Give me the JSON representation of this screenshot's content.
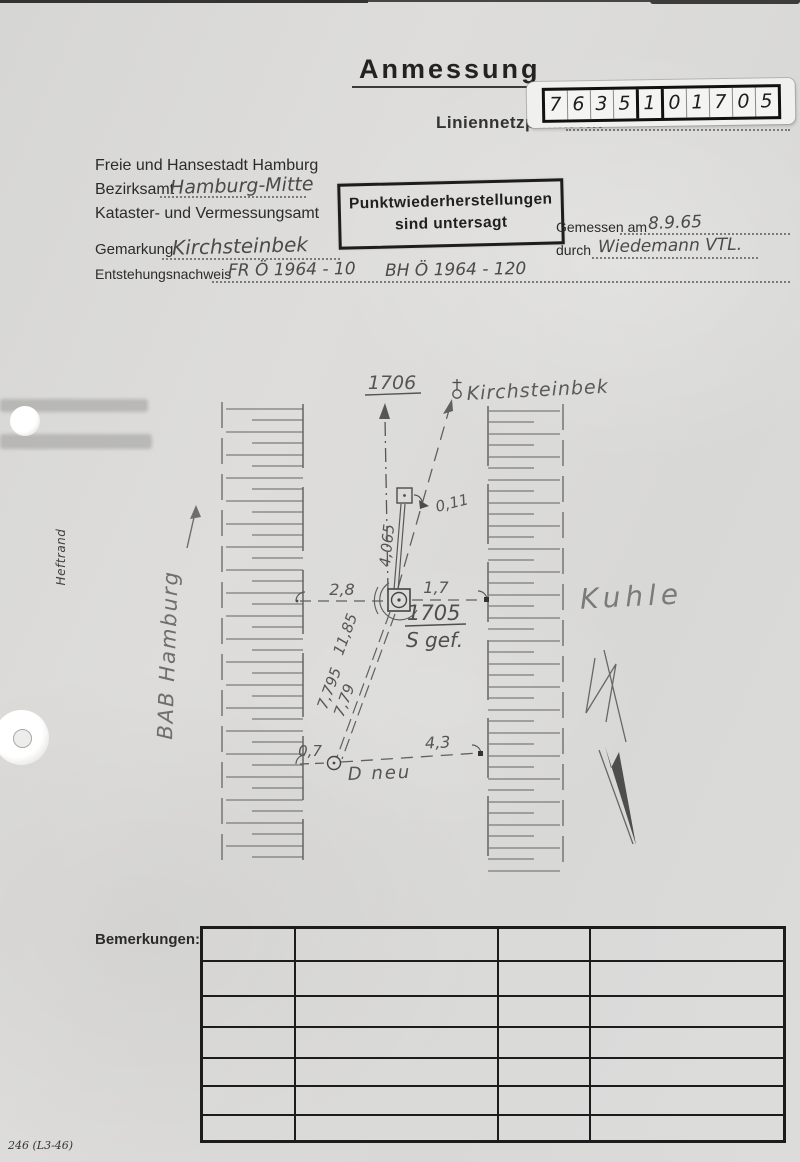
{
  "page": {
    "margin_label": "Heftrand",
    "form_code": "246 (L3-46)"
  },
  "header": {
    "title": "Anmessung",
    "point_label": "Liniennetzpunkt Nr.",
    "point_number_digits": [
      "7",
      "6",
      "3",
      "5",
      "1",
      "0",
      "1",
      "7",
      "0",
      "5"
    ]
  },
  "office": {
    "line1": "Freie und Hansestadt Hamburg",
    "bezirksamt_label": "Bezirksamt",
    "bezirksamt_value": "Hamburg-Mitte",
    "line3": "Kataster- und Vermessungsamt"
  },
  "stamp": {
    "line1": "Punktwiederherstellungen",
    "line2": "sind untersagt"
  },
  "fields": {
    "gemessen_label": "Gemessen am",
    "gemessen_value": "8.9.65",
    "durch_label": "durch",
    "durch_value": "Wiedemann VTL.",
    "gemarkung_label": "Gemarkung",
    "gemarkung_value": "Kirchsteinbek",
    "entstehung_label": "Entstehungsnachweis",
    "entstehung_value_a": "FR Ö 1964 - 10",
    "entstehung_value_b": "BH Ö 1964 - 120"
  },
  "sketch": {
    "north_point": "1706",
    "church_label": "Kirchsteinbek",
    "road_label": "BAB Hamburg",
    "pit_label": "Kuhle",
    "main_point": "1705",
    "main_point_note": "S gef.",
    "new_point": "D neu",
    "measurements": {
      "to_marker": "4,065",
      "marker_offset": "0,11",
      "left": "2,8",
      "right": "1,7",
      "diagonal": "11,85",
      "to_d_a": "7,795",
      "to_d_b": "7,79",
      "d_left": "0,7",
      "d_right": "4,3"
    }
  },
  "remarks": {
    "label": "Bemerkungen:"
  }
}
